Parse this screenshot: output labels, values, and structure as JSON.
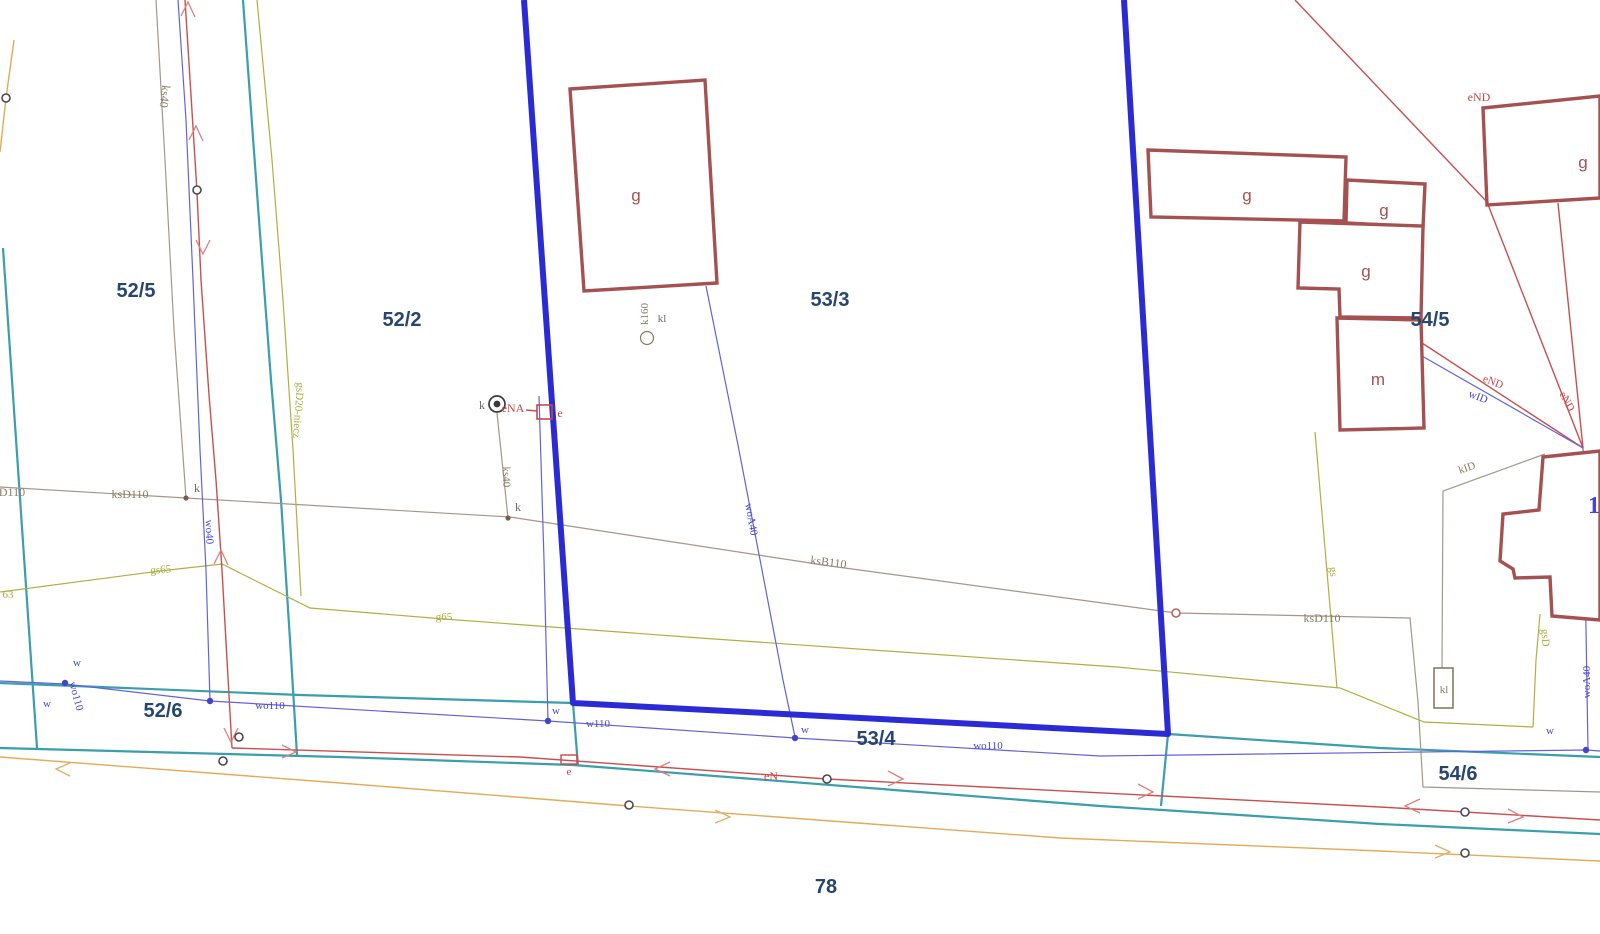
{
  "map": {
    "colors": {
      "parcel": "#26466E",
      "boundary": "#2B2BD6",
      "teal": "#3A9EAB",
      "red": "#C94747",
      "blue": "#4646CE",
      "olive": "#A9AC3C",
      "brown": "#8C7A62",
      "grey": "#6B6B6B",
      "orange": "#E4AB57",
      "building": "#A65151",
      "water": "#6363D8",
      "sewer": "#A4978A"
    },
    "parcel_labels": [
      {
        "n": "parcel-52-5",
        "t": "52/5",
        "x": 136,
        "y": 297
      },
      {
        "n": "parcel-52-2",
        "t": "52/2",
        "x": 402,
        "y": 326
      },
      {
        "n": "parcel-53-3",
        "t": "53/3",
        "x": 830,
        "y": 306
      },
      {
        "n": "parcel-54-5",
        "t": "54/5",
        "x": 1430,
        "y": 326
      },
      {
        "n": "parcel-52-6",
        "t": "52/6",
        "x": 163,
        "y": 717
      },
      {
        "n": "parcel-53-4",
        "t": "53/4",
        "x": 876,
        "y": 745
      },
      {
        "n": "parcel-54-6",
        "t": "54/6",
        "x": 1458,
        "y": 780
      },
      {
        "n": "parcel-78",
        "t": "78",
        "x": 826,
        "y": 893
      }
    ],
    "building_labels": [
      {
        "n": "building-label-g-1",
        "t": "g",
        "x": 636,
        "y": 201
      },
      {
        "n": "building-label-g-2",
        "t": "g",
        "x": 1247,
        "y": 201
      },
      {
        "n": "building-label-g-3",
        "t": "g",
        "x": 1384,
        "y": 216
      },
      {
        "n": "building-label-g-4",
        "t": "g",
        "x": 1366,
        "y": 277
      },
      {
        "n": "building-label-m",
        "t": "m",
        "x": 1378,
        "y": 385
      },
      {
        "n": "building-label-g-5",
        "t": "g",
        "x": 1583,
        "y": 168
      }
    ],
    "labels": [
      {
        "n": "label-ks40-left",
        "t": "ks40",
        "x": 161,
        "y": 96,
        "c": "brown",
        "r": 97,
        "s": 12
      },
      {
        "n": "label-gsd20-niecz",
        "t": "gsD20-niecz",
        "x": 295,
        "y": 410,
        "c": "olive",
        "r": 94,
        "s": 11
      },
      {
        "n": "label-k-manhole",
        "t": "k",
        "x": 482,
        "y": 409,
        "c": "grey",
        "s": 12
      },
      {
        "n": "label-ena",
        "t": "eNA",
        "x": 513,
        "y": 412,
        "c": "red",
        "s": 12
      },
      {
        "n": "label-e-top",
        "t": "e",
        "x": 560,
        "y": 417,
        "c": "red",
        "s": 12
      },
      {
        "n": "label-ks40-right",
        "t": "ks40",
        "x": 503,
        "y": 477,
        "c": "brown",
        "r": 88,
        "s": 11
      },
      {
        "n": "label-k-dot-right",
        "t": "k",
        "x": 518,
        "y": 511,
        "c": "grey",
        "s": 12
      },
      {
        "n": "label-wo40",
        "t": "wo40",
        "x": 206,
        "y": 532,
        "c": "blue",
        "r": 88,
        "s": 11
      },
      {
        "n": "label-ksd110-left",
        "t": "ksD110",
        "x": 130,
        "y": 498,
        "c": "brown",
        "s": 12
      },
      {
        "n": "label-ksd110-edge",
        "t": "D110",
        "x": 12,
        "y": 496,
        "c": "brown",
        "s": 12
      },
      {
        "n": "label-k-dot-left",
        "t": "k",
        "x": 197,
        "y": 492,
        "c": "grey",
        "s": 12
      },
      {
        "n": "label-gs65",
        "t": "gs65",
        "x": 161,
        "y": 573,
        "c": "olive",
        "s": 11,
        "r": -4
      },
      {
        "n": "label-gs63-edge",
        "t": "63",
        "x": 8,
        "y": 598,
        "c": "olive",
        "s": 11
      },
      {
        "n": "label-g65",
        "t": "g65",
        "x": 444,
        "y": 620,
        "c": "olive",
        "s": 11
      },
      {
        "n": "label-woa40-mid",
        "t": "woA40",
        "x": 748,
        "y": 520,
        "c": "blue",
        "r": 80,
        "s": 11
      },
      {
        "n": "label-ksb110",
        "t": "ksB110",
        "x": 828,
        "y": 566,
        "c": "brown",
        "r": 7,
        "s": 12
      },
      {
        "n": "label-kl-mid",
        "t": "kl",
        "x": 662,
        "y": 322,
        "c": "grey",
        "s": 11
      },
      {
        "n": "label-k160",
        "t": "k160",
        "x": 648,
        "y": 314,
        "c": "brown",
        "r": -90,
        "s": 11
      },
      {
        "n": "label-w-1",
        "t": "w",
        "x": 77,
        "y": 666,
        "c": "blue",
        "s": 11
      },
      {
        "n": "label-w-2",
        "t": "w",
        "x": 47,
        "y": 707,
        "c": "blue",
        "s": 11
      },
      {
        "n": "label-wo110-rot",
        "t": "wo110",
        "x": 73,
        "y": 697,
        "c": "blue",
        "r": 75,
        "s": 11
      },
      {
        "n": "label-wo110-left",
        "t": "wo110",
        "x": 270,
        "y": 709,
        "c": "blue",
        "s": 11
      },
      {
        "n": "label-w-3",
        "t": "w",
        "x": 556,
        "y": 714,
        "c": "blue",
        "s": 11
      },
      {
        "n": "label-w110",
        "t": "w110",
        "x": 598,
        "y": 727,
        "c": "blue",
        "s": 11
      },
      {
        "n": "label-w-4",
        "t": "w",
        "x": 805,
        "y": 733,
        "c": "blue",
        "s": 11
      },
      {
        "n": "label-wo110-right",
        "t": "wo110",
        "x": 988,
        "y": 749,
        "c": "blue",
        "s": 11
      },
      {
        "n": "label-e-road",
        "t": "e",
        "x": 569,
        "y": 775,
        "c": "red",
        "s": 11
      },
      {
        "n": "label-en",
        "t": "eN",
        "x": 771,
        "y": 780,
        "c": "red",
        "s": 12
      },
      {
        "n": "label-end-top",
        "t": "eND",
        "x": 1479,
        "y": 101,
        "c": "red",
        "s": 12
      },
      {
        "n": "label-end-diag1",
        "t": "eND",
        "x": 1492,
        "y": 385,
        "c": "red",
        "r": 21,
        "s": 11
      },
      {
        "n": "label-wid",
        "t": "wID",
        "x": 1477,
        "y": 400,
        "c": "blue",
        "r": 21,
        "s": 11
      },
      {
        "n": "label-end-diag2",
        "t": "eND",
        "x": 1564,
        "y": 403,
        "c": "red",
        "r": 62,
        "s": 11
      },
      {
        "n": "label-kid",
        "t": "kID",
        "x": 1468,
        "y": 471,
        "c": "brown",
        "r": -19,
        "s": 11
      },
      {
        "n": "label-gs-right",
        "t": "gs",
        "x": 1330,
        "y": 572,
        "c": "olive",
        "r": 85,
        "s": 11
      },
      {
        "n": "label-ksd110-right",
        "t": "ksD110",
        "x": 1322,
        "y": 622,
        "c": "brown",
        "s": 12
      },
      {
        "n": "label-gsd",
        "t": "gsD",
        "x": 1542,
        "y": 638,
        "c": "olive",
        "r": 87,
        "s": 11
      },
      {
        "n": "label-woa40-right",
        "t": "woA40",
        "x": 1590,
        "y": 682,
        "c": "blue",
        "r": -90,
        "s": 11
      },
      {
        "n": "label-kl-box",
        "t": "kl",
        "x": 1444,
        "y": 693,
        "c": "brown",
        "s": 11
      },
      {
        "n": "label-w-5",
        "t": "w",
        "x": 1550,
        "y": 734,
        "c": "blue",
        "s": 11
      },
      {
        "n": "label-digit-1-partial",
        "t": "1",
        "x": 1594,
        "y": 513,
        "c": "blue",
        "s": 24,
        "b": 1
      }
    ]
  }
}
